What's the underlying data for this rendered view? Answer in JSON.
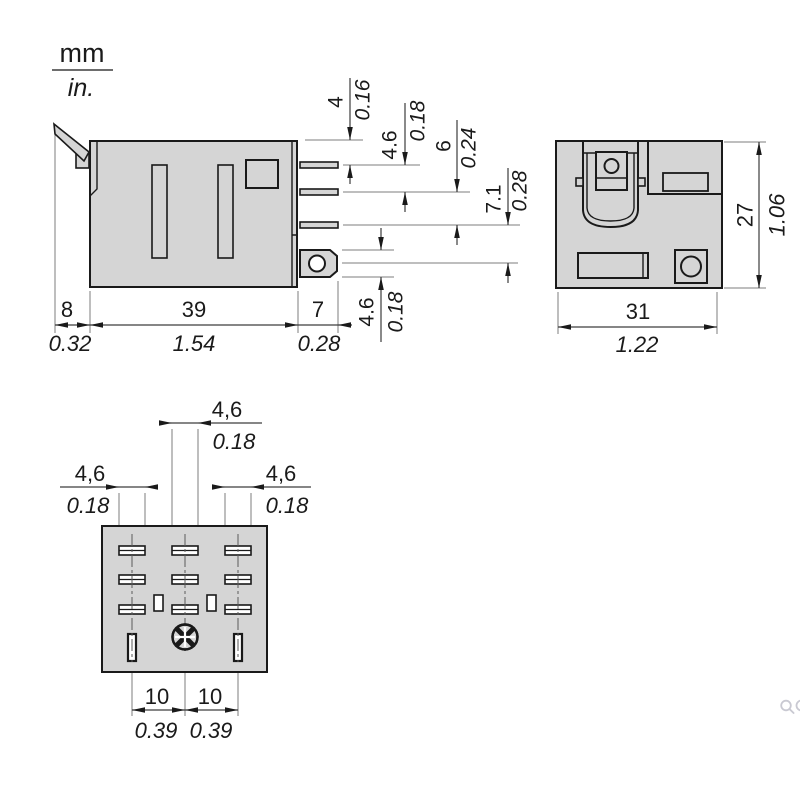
{
  "unit_legend": {
    "mm_label": "mm",
    "in_label": "in."
  },
  "side_view": {
    "right_dims": [
      {
        "mm": "4",
        "in": "0.16"
      },
      {
        "mm": "4.6",
        "in": "0.18"
      },
      {
        "mm": "6",
        "in": "0.24"
      },
      {
        "mm": "7.1",
        "in": "0.28"
      },
      {
        "mm": "4.6",
        "in": "0.18"
      }
    ],
    "bottom_dims": [
      {
        "mm": "8",
        "in": "0.32"
      },
      {
        "mm": "39",
        "in": "1.54"
      },
      {
        "mm": "7",
        "in": "0.28"
      }
    ]
  },
  "front_view": {
    "height_dim": {
      "mm": "27",
      "in": "1.06"
    },
    "width_dim": {
      "mm": "31",
      "in": "1.22"
    }
  },
  "bottom_view": {
    "blade_dims": [
      {
        "mm": "4,6",
        "in": "0.18"
      },
      {
        "mm": "4,6",
        "in": "0.18"
      },
      {
        "mm": "4,6",
        "in": "0.18"
      }
    ],
    "pitch_dims": [
      {
        "mm": "10",
        "in": "0.39"
      },
      {
        "mm": "10",
        "in": "0.39"
      }
    ]
  },
  "watermark": {
    "zoom_icon": "magnifier"
  },
  "colors": {
    "body_fill": "#d5d5d5",
    "outline": "#1a1a1a",
    "dim_line": "#3d3d3d",
    "ext_line": "#7c7c7c",
    "watermark": "#c9c9d2"
  }
}
